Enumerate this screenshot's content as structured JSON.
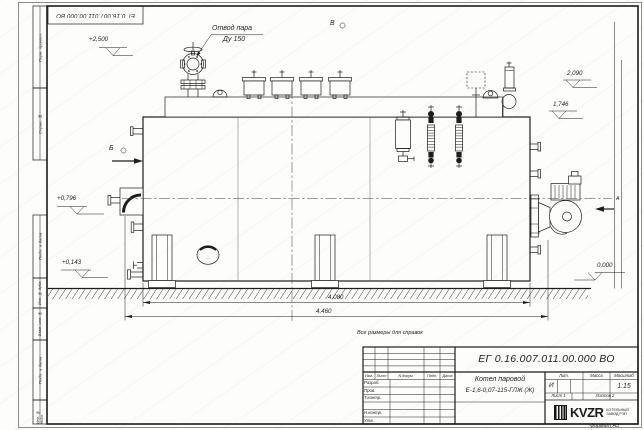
{
  "sheet": {
    "stamp_top": "ЕГ 0.16.007.011.00.000  ВО",
    "format": "Формат А3",
    "note": "Все размеры для справок",
    "frame_columns": [
      "Перв. примен.",
      "Справ. №",
      "Подп. и дата",
      "Инв. № дубл.",
      "Взам. инв. №",
      "Подп. и дата",
      "Инв. № подл."
    ]
  },
  "drawing": {
    "callouts": {
      "steam_outlet": "Отвод пара",
      "steam_outlet_dn": "Ду 150"
    },
    "view_labels": {
      "b": "Б",
      "v": "В",
      "a": "А"
    },
    "elevations": {
      "top_valve": "+2,500",
      "safety_valve": "2,090",
      "shell_top": "1,746",
      "axis": "+0,796",
      "low_fitting": "+0,143",
      "ground": "0,000"
    },
    "dimensions": {
      "shell_length": "4,080",
      "overall_length": "4,460"
    }
  },
  "title_block": {
    "doc_number": "ЕГ 0.16.007.011.00.000  ВО",
    "product_line1": "Котел паровой",
    "product_line2": "Е-1,6-0,07-115-ГЛЖ (Ж)",
    "columns": [
      "Изм.",
      "Лист",
      "N докум.",
      "Подп.",
      "Дата"
    ],
    "rows": [
      "Разраб.",
      "Пров.",
      "Т.контр.",
      "",
      "Н.контр.",
      "Утв."
    ],
    "lit_label": "Лит.",
    "lit_value": "И",
    "mass_label": "Масса",
    "scale_label": "Масштаб",
    "scale_value": "1:15",
    "sheet_cell": "Лист 1",
    "sheets_cell": "Листов 2",
    "company": {
      "abbr": "KVZR",
      "line1": "КОТЕЛЬНЫЙ",
      "line2": "ЗАВОД РЭП"
    }
  }
}
